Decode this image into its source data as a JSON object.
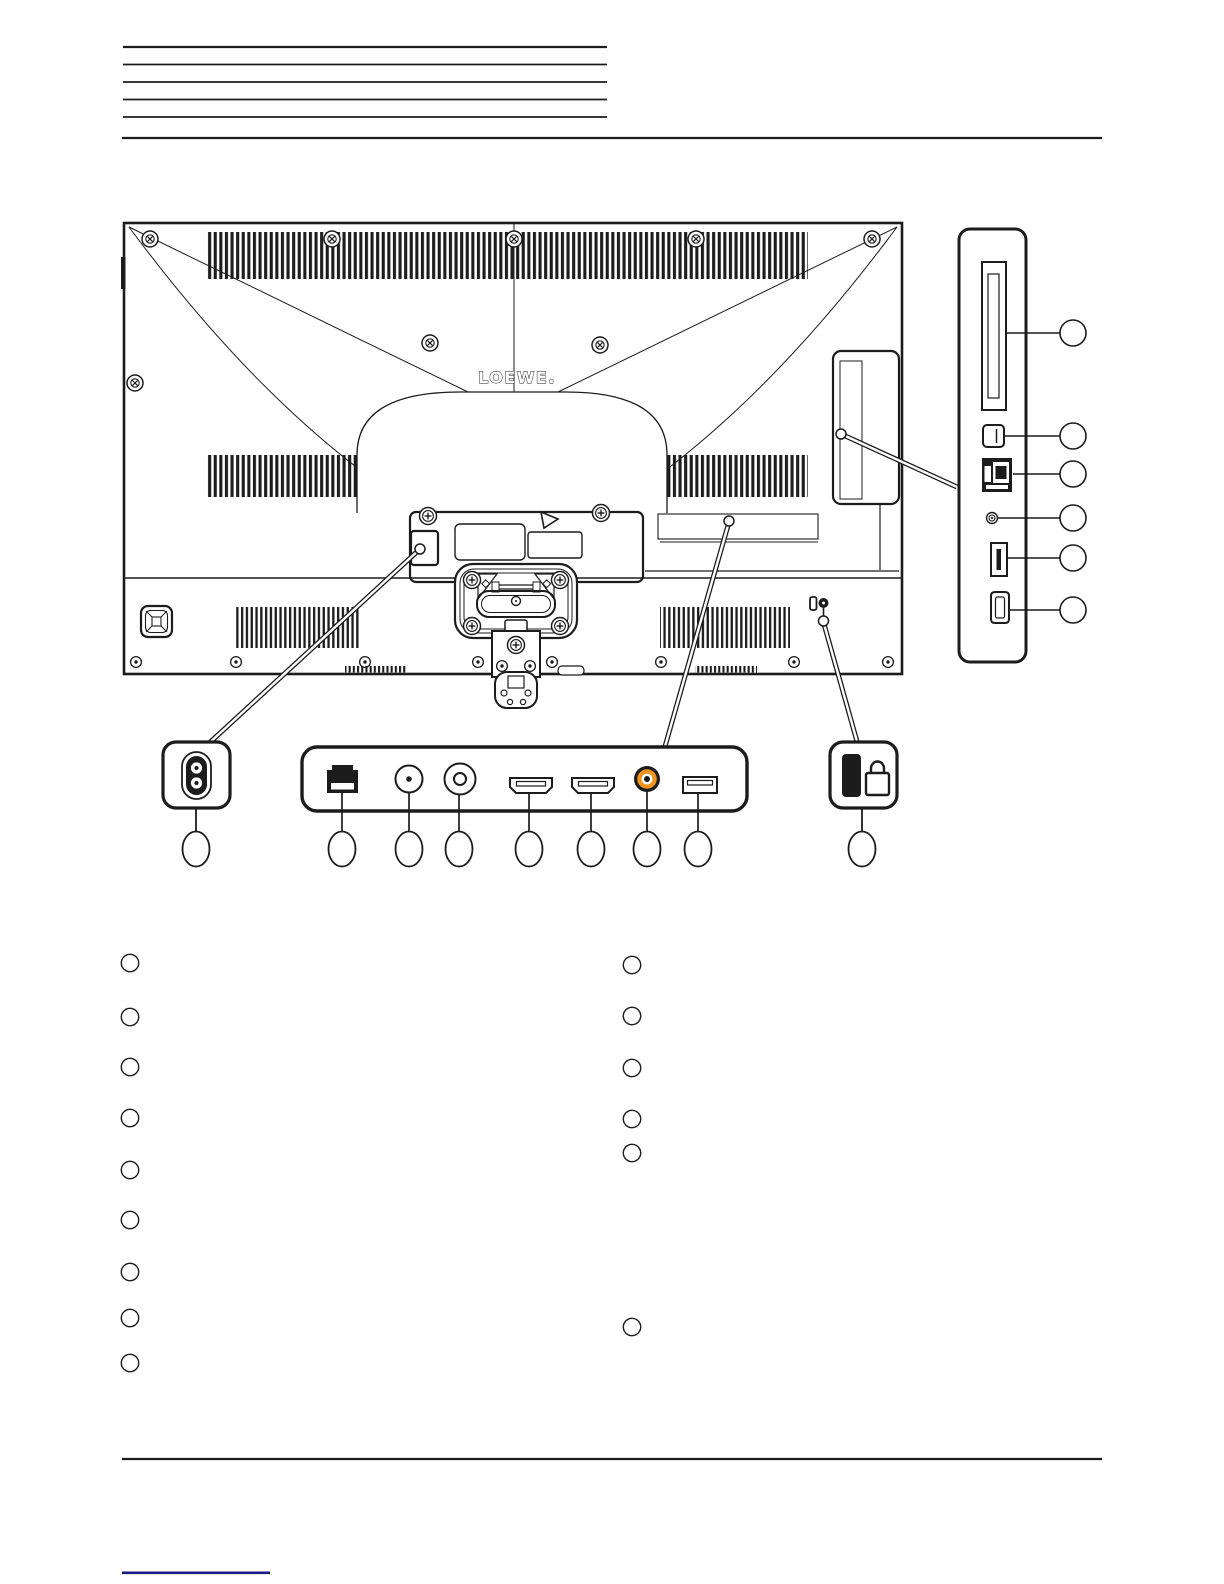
{
  "page": {
    "background_color": "#ffffff",
    "ink_color": "#1c1c1c",
    "footer_accent_color": "#1a1a80",
    "rca_accent_color": "#F0941F"
  },
  "header": {
    "redacted_line_count": 5,
    "has_full_width_rule": true
  },
  "tv_diagram": {
    "brand_logo": "LOEWE.",
    "view": "rear-view-of-television",
    "side_panel_detail": {
      "port_icons": [
        "ci-card-slot-icon",
        "optical-audio-port-icon",
        "lan-port-icon",
        "headphone-jack-icon",
        "usb-port-icon",
        "hdmi-port-icon"
      ],
      "callout_marker_count": 6,
      "callout_labels": [
        "",
        "",
        "",
        "",
        "",
        ""
      ]
    },
    "power_inlet_detail": {
      "port_icons": [
        "power-inlet-icon"
      ],
      "callout_marker_count": 1,
      "callout_labels": [
        ""
      ]
    },
    "rear_terminal_strip_detail": {
      "port_icons": [
        "lan-port-icon",
        "rf-antenna-jack-icon",
        "sat-antenna-jack-icon",
        "hdmi-port-icon",
        "hdmi-port-icon",
        "audio-rca-jack-icon",
        "usb-port-icon"
      ],
      "callout_marker_count": 7,
      "callout_labels": [
        "",
        "",
        "",
        "",
        "",
        "",
        ""
      ]
    },
    "kensington_detail": {
      "port_icons": [
        "kensington-lock-icon",
        "padlock-icon"
      ],
      "callout_marker_count": 1,
      "callout_labels": [
        ""
      ]
    }
  },
  "legend": {
    "left_column_marker_count": 9,
    "left_column_labels": [
      "",
      "",
      "",
      "",
      "",
      "",
      "",
      "",
      ""
    ],
    "right_column_marker_count": 6,
    "right_column_labels": [
      "",
      "",
      "",
      "",
      "",
      ""
    ]
  },
  "footer": {
    "has_full_width_rule": true,
    "has_accent_underline": true
  }
}
